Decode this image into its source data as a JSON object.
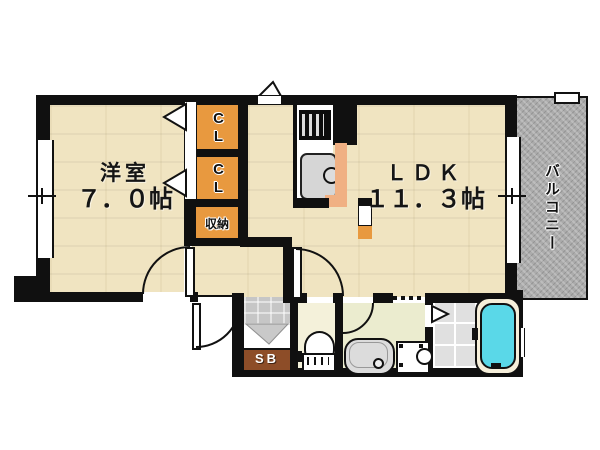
{
  "plan_title": "apartment-floor-plan",
  "colors": {
    "wall": "#101010",
    "floor_beige": "#f0e4c1",
    "closet_orange": "#e8993f",
    "balcony_gray": "#ababab",
    "shoe_box_brown": "#8d4d28",
    "bathtub_cyan": "#5ad8e8",
    "counter_peach": "#f0b083",
    "tile_gray": "#e0e0e0",
    "toilet_floor": "#f4f1da",
    "washroom_floor": "#ebeccf",
    "genkan_gray": "#c6c6c6"
  },
  "rooms": {
    "western": {
      "name": "洋室",
      "size": "７．０帖"
    },
    "ldk": {
      "name": "ＬＤＫ",
      "size": "１１．３帖"
    },
    "balcony": {
      "label": "バルコニー"
    },
    "storage": {
      "label": "収納"
    },
    "shoe_box": {
      "label": "SB"
    }
  },
  "closets": [
    {
      "label": "CL"
    },
    {
      "label": "CL"
    }
  ]
}
